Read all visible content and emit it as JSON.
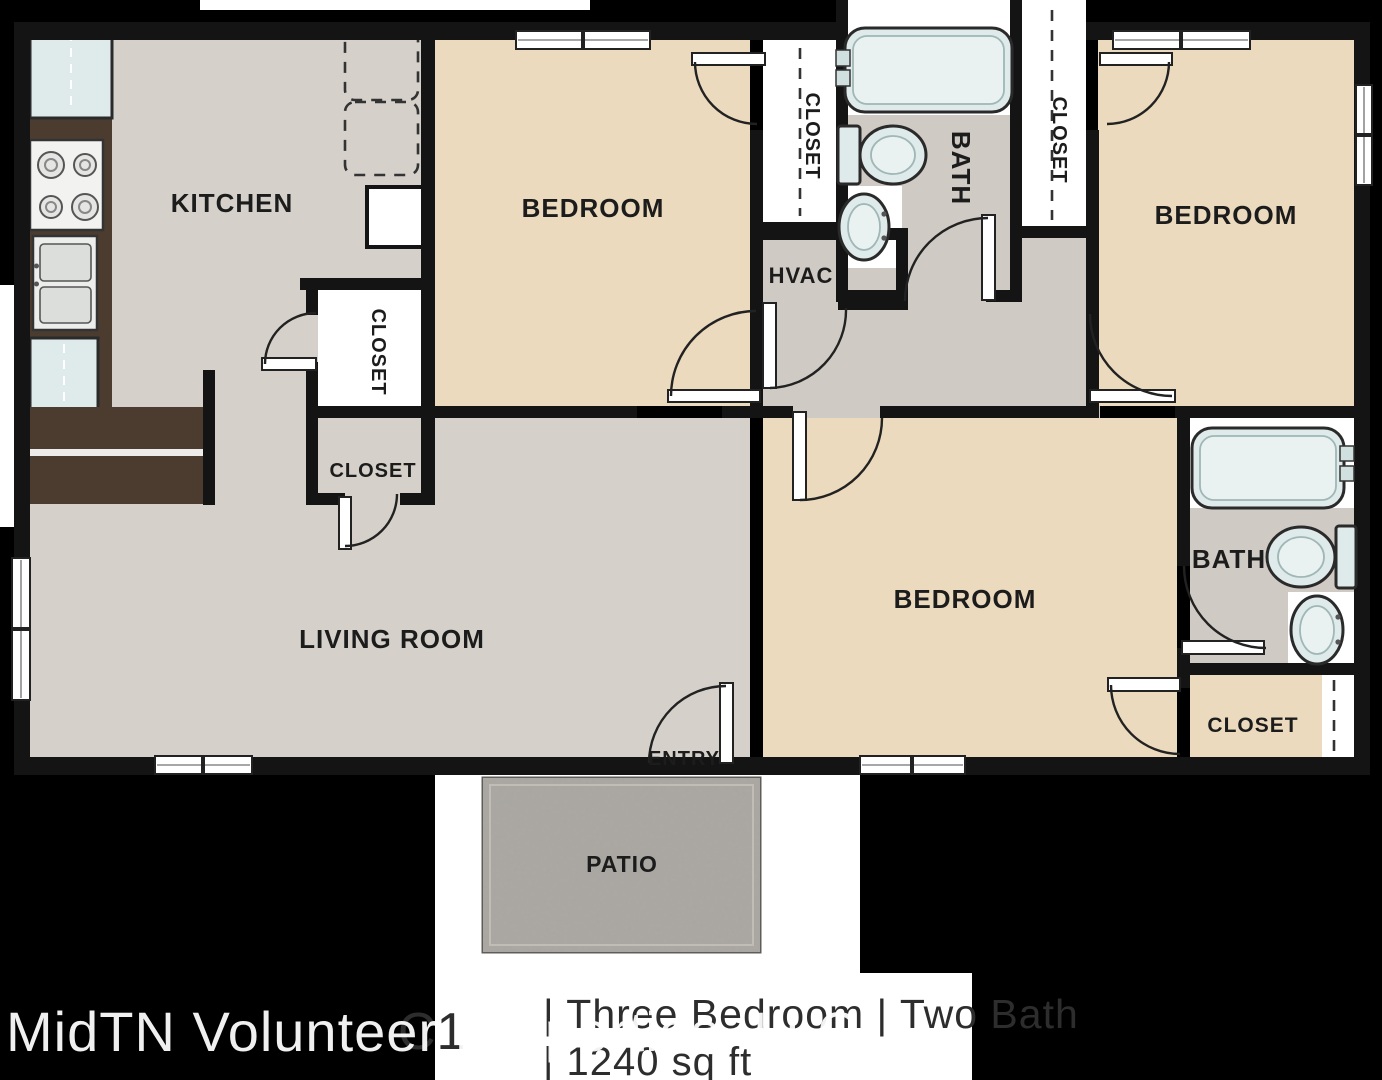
{
  "floor_plan": {
    "watermark": "MidTN Volunteer Properties, LLC",
    "title": {
      "plan_code": "C1",
      "line1": "| Three Bedroom | Two Bath",
      "line2": "| 1240 sq ft"
    },
    "labels": {
      "kitchen": "KITCHEN",
      "bedroom": "BEDROOM",
      "living_room": "LIVING ROOM",
      "bath": "BATH",
      "closet": "CLOSET",
      "hvac": "HVAC",
      "entry": "ENTRY",
      "patio": "PATIO"
    },
    "colors": {
      "background": "#000000",
      "wall": "#141414",
      "bedroom_floor": "#ebdabd",
      "kitchen_living_floor": "#d5d1ca",
      "hall_bath_floor": "#cfcac3",
      "closet_floor": "#ffffff",
      "counter_brown": "#4b3c2f",
      "fixture_blue": "#dfeaea",
      "patio_gray": "#a8a5a0",
      "label_text": "#1c1c1c",
      "title_text": "#2d2d2d",
      "watermark_text": "#f5f5f5"
    }
  }
}
